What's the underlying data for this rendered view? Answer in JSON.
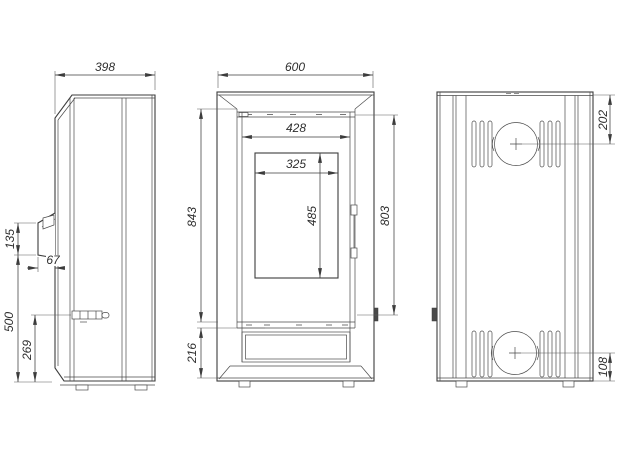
{
  "drawing": {
    "type": "technical-orthographic-views",
    "subject": "free-standing stove, three dimensioned views (side, front, back)",
    "units": "mm",
    "colors": {
      "line": "#3c3c3c",
      "text": "#2e2e2e",
      "background": "#ffffff"
    },
    "dims": {
      "side_depth": "398",
      "side_handle_height": "135",
      "side_handle_depth": "67",
      "side_handle_elevation": "500",
      "side_damper_elevation": "269",
      "front_width": "600",
      "front_door_width": "428",
      "front_glass_width": "325",
      "front_glass_height": "485",
      "front_body_height": "843",
      "front_door_height": "803",
      "front_base_height": "216",
      "back_flue_top_offset": "202",
      "back_flue_bottom_offset": "108"
    }
  }
}
